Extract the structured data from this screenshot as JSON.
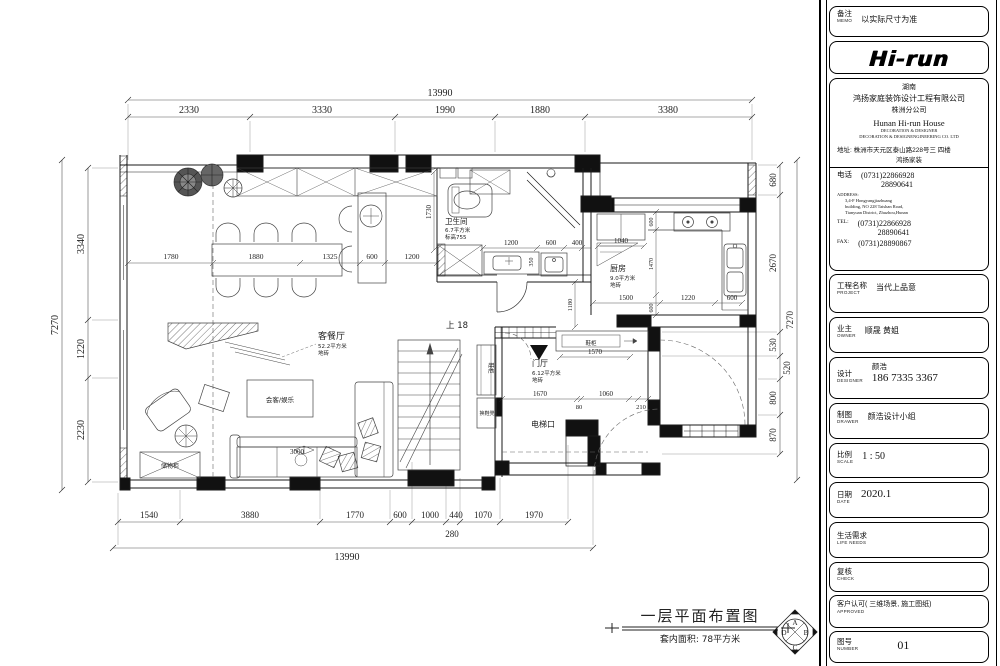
{
  "title_block": {
    "memo": {
      "cn": "备注",
      "en": "MEMO",
      "value": "以实际尺寸为准"
    },
    "logo_text": "Hi-run",
    "company": {
      "region": "湖南",
      "name_cn": "鸿扬家庭装饰设计工程有限公司",
      "branch": "株洲分公司",
      "name_en": "Hunan  Hi-run  House",
      "sub_en1": "DECORATION & DESIGNER",
      "sub_en2": "DECORATION & DESIGNENGINEERING CO. LTD",
      "addr_label": "地址:",
      "addr_value1": "株洲市天元区泰山路228号三 四楼",
      "addr_value2": "鸿扬家装"
    },
    "contact": {
      "phone_label": "电话",
      "phone1": "(0731)22866928",
      "phone2": "28890641",
      "address_label": "ADDRESS:",
      "address1": "3,4-F Hongyangjiazhuang",
      "address2": "building, NO 228 Taishan Road,",
      "address3": "Tianyuan District, Zhuzhou,Hunan",
      "tel_label": "TEL:",
      "tel1": "(0731)22866928",
      "tel2": "28890641",
      "fax_label": "FAX:",
      "fax": "(0731)28890867"
    },
    "project": {
      "cn": "工程名称",
      "en": "PROJECT",
      "value": "当代上品意"
    },
    "owner": {
      "cn": "业主",
      "en": "OWNER",
      "value": "顺晟  黄姐"
    },
    "designer": {
      "cn": "设计",
      "en": "DESIGNER",
      "name": "颜浩",
      "phone": "186  7335  3367"
    },
    "drawer": {
      "cn": "制图",
      "en": "DRAWER",
      "value": "颜浩设计小组"
    },
    "scale": {
      "cn": "比例",
      "en": "SCALE",
      "value": "1 : 50"
    },
    "date": {
      "cn": "日期",
      "en": "DATE",
      "value": "2020.1"
    },
    "life": {
      "cn": "生活需求",
      "en": "LIFE  NEEDS",
      "value": ""
    },
    "check": {
      "cn": "复核",
      "en": "CHECK",
      "value": ""
    },
    "approved": {
      "cn": "客户认可( 三维场景, 施工图纸)",
      "en": "APPROVED",
      "value": ""
    },
    "number": {
      "cn": "图号",
      "en": "NUMBER",
      "value": "01"
    }
  },
  "footer": {
    "title": "一层平面布置图",
    "subtitle": "套内面积: 78平方米",
    "compass": {
      "n": "A",
      "e": "B",
      "s": "C",
      "w": "D"
    }
  },
  "plan": {
    "dims": {
      "top_total": "13990",
      "top": [
        "2330",
        "3330",
        "1990",
        "1880",
        "3380"
      ],
      "bottom": [
        "1540",
        "3880",
        "1770",
        "600",
        "1000",
        "440",
        "1070",
        "1970"
      ],
      "bottom_extra": "280",
      "bottom_total": "13990",
      "left_total": "7270",
      "left": [
        "3340",
        "1220",
        "2230"
      ],
      "right": [
        "680",
        "2670",
        "530",
        "520",
        "800",
        "870"
      ],
      "right_total": "7270",
      "dining": [
        "1780",
        "1880",
        "1325",
        "600",
        "1200"
      ],
      "bath": [
        "1200",
        "600",
        "400"
      ],
      "bath_h": "1730",
      "bath_v": "350",
      "corridor_v": "1180",
      "fridge_w": "1040",
      "kitchen": [
        "1500",
        "1220",
        "600"
      ],
      "kitchen_v": [
        "600",
        "1470",
        "600"
      ],
      "shoe_w": "1570",
      "entry": [
        "1670",
        "80",
        "1060",
        "210"
      ],
      "sofa_w": "3000"
    },
    "labels": {
      "living_name": "客餐厅",
      "living_area": "52.2平方米",
      "living_floor": "地砖",
      "bath_name": "卫生间",
      "bath_area": "6.7平方米",
      "bath_note": "标高755",
      "kitchen_name": "厨房",
      "kitchen_area": "9.0平方米",
      "kitchen_floor": "地砖",
      "foyer_name": "门厅",
      "foyer_area": "6.12平方米",
      "foyer_floor": "地砖",
      "elevator": "电梯口",
      "meeting": "会客/娱乐",
      "storage": "储物柜",
      "shoe_cabinet": "鞋柜",
      "shoe_bench": "换鞋凳",
      "stairs_up": "上 18"
    }
  }
}
